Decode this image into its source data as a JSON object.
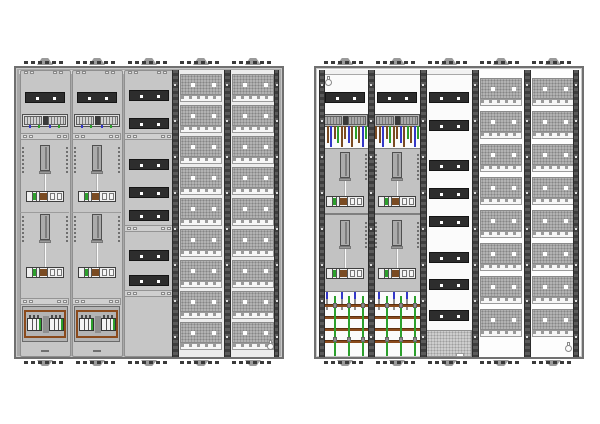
{
  "diagram": {
    "description": "Technical front-view drawings of two five-field electricity meter distribution cabinets, left cabinet fully covered, right cabinet open-frame with visible wiring and busbars",
    "background": "#ffffff",
    "mounting_brackets_per_cabinet": 5
  },
  "palette": {
    "frame_border": "#707070",
    "frame_inner": "#c8c8c8",
    "covered_interior": "#a8a8a8",
    "open_interior": "#fbfbfb",
    "panel_fill": "#c6c6c6",
    "panel_border": "#8f8f8f",
    "head_fill_covered": "#d6d6d6",
    "head_fill_open": "#f1f1f1",
    "joint_fill": "#cfcfcf",
    "strip_dark": "#2d2d2d",
    "perf_backplane_covered": "#ececec",
    "perf_backplane_open": "#fdfdfd",
    "busbar_brown": "#8a4a1c",
    "wire_brown": "#7a4b22",
    "wire_blue": "#3438c8",
    "wire_green": "#2ca02c",
    "meter_plate": "#c2c2c2",
    "white_element": "#f4f4f4",
    "bracket_dark": "#3a3a3a",
    "bracket_bump": "#9b9b9b",
    "clamp_gray": "#8d8d8d"
  },
  "meter_covered": {
    "strip_y": 24,
    "terminal_y": 46,
    "joints": [
      65,
      230
    ],
    "mid_line_y": 144,
    "meters": [
      {
        "bar_y": 77,
        "strip_y": 123
      },
      {
        "bar_y": 146,
        "strip_y": 199
      }
    ],
    "terminal_ticks": [
      {
        "pos": 0.15,
        "color": "#3438c8"
      },
      {
        "pos": 0.36,
        "color": "#2ca02c"
      },
      {
        "pos": 0.6,
        "color": "#3438c8"
      },
      {
        "pos": 0.82,
        "color": "#2ca02c"
      }
    ],
    "breaker_y": 238,
    "cover_dash_y": 282
  },
  "meter_open": {
    "strip_y": 24,
    "terminal_y": 46,
    "wires_y": 58,
    "wire_colors": [
      "#7a4b22",
      "#7a4b22",
      "#3438c8",
      "#7a4b22",
      "#2ca02c",
      "#7a4b22",
      "#7a4b22",
      "#3438c8",
      "#7a4b22",
      "#2ca02c",
      "#7a4b22",
      "#3438c8",
      "#2ca02c"
    ],
    "plates": [
      {
        "y": 80,
        "h": 66
      },
      {
        "y": 146,
        "h": 78
      }
    ],
    "meters": [
      {
        "bar_y": 84,
        "strip_y": 128
      },
      {
        "bar_y": 152,
        "strip_y": 200
      }
    ],
    "busbar_ys": [
      236,
      248,
      260,
      272
    ],
    "green_wire_pos": [
      0.28,
      0.55,
      0.82
    ],
    "drop_wire_pos": [
      0.14,
      0.42,
      0.68
    ]
  },
  "cabinets": [
    {
      "name": "cabinet-covered",
      "style": "covered",
      "rails": [
        {
          "x": 156,
          "w": 7
        },
        {
          "x": 208,
          "w": 7
        },
        {
          "x": 258,
          "w": 5
        }
      ],
      "keyholes": [
        {
          "x": 250,
          "y": 272
        }
      ],
      "columns": [
        {
          "name": "meter-field-1",
          "type": "meter_covered"
        },
        {
          "name": "meter-field-2",
          "type": "meter_covered"
        },
        {
          "name": "device-field",
          "type": "device_covered",
          "strips": [
            22,
            50,
            91,
            119,
            142,
            182,
            207
          ],
          "joints": [
            65,
            157,
            222
          ]
        },
        {
          "name": "distribution-field-1",
          "type": "perf_rows",
          "rows": 9,
          "row_start": 6,
          "pitch": 31
        },
        {
          "name": "distribution-field-2",
          "type": "perf_rows",
          "rows": 9,
          "row_start": 6,
          "pitch": 31
        }
      ]
    },
    {
      "name": "cabinet-open-frame",
      "style": "open",
      "rails": [
        {
          "x": 3,
          "w": 6
        },
        {
          "x": 52,
          "w": 7
        },
        {
          "x": 104,
          "w": 7
        },
        {
          "x": 156,
          "w": 7
        },
        {
          "x": 208,
          "w": 7
        },
        {
          "x": 257,
          "w": 6
        }
      ],
      "keyholes": [
        {
          "x": 8,
          "y": 8
        },
        {
          "x": 248,
          "y": 274
        }
      ],
      "columns": [
        {
          "name": "meter-field-1",
          "type": "meter_open"
        },
        {
          "name": "meter-field-2",
          "type": "meter_open"
        },
        {
          "name": "device-field",
          "type": "device_open",
          "strips": [
            24,
            52,
            92,
            120,
            148,
            184,
            211,
            242
          ],
          "bottom_plate_y": 262
        },
        {
          "name": "distribution-field-1",
          "type": "perf_rows",
          "rows": 8,
          "row_start": 10,
          "pitch": 33
        },
        {
          "name": "distribution-field-2",
          "type": "perf_rows",
          "rows": 8,
          "row_start": 10,
          "pitch": 33
        }
      ]
    }
  ]
}
